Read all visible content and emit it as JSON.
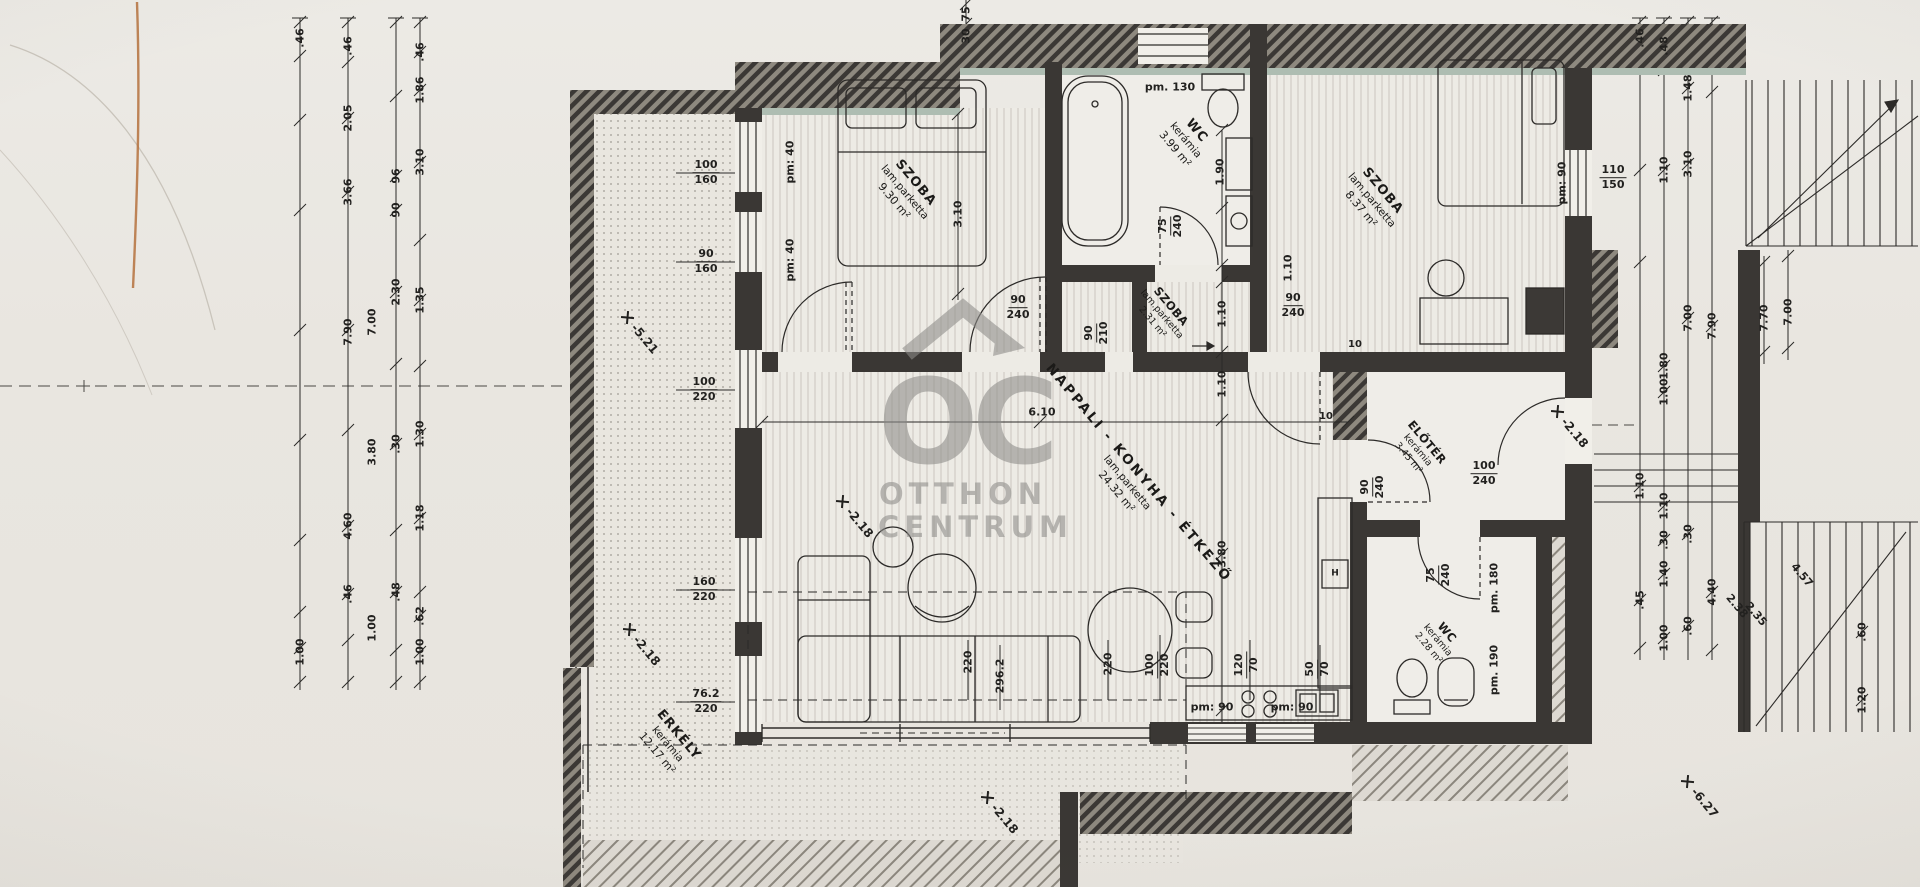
{
  "watermark": {
    "oc": "OC",
    "line1": "OTTHON",
    "line2": "CENTRUM"
  },
  "rooms": [
    {
      "name": "SZOBA",
      "mat": "lam.parketta",
      "area": "9.30 m²",
      "x": 905,
      "y": 192,
      "cls": ""
    },
    {
      "name": "WC",
      "mat": "kerámia",
      "area": "3.99 m²",
      "x": 1186,
      "y": 140,
      "cls": ""
    },
    {
      "name": "SZOBA",
      "mat": "lam.parketta",
      "area": "8.37 m²",
      "x": 1372,
      "y": 200,
      "cls": ""
    },
    {
      "name": "SZOBA",
      "mat": "lam.parketta",
      "area": "2.31 m²",
      "x": 1162,
      "y": 314,
      "cls": "sm"
    },
    {
      "name": "NAPPALI - KONYHA - ÉTKEZŐ",
      "mat": "lam.parketta",
      "area": "24.32 m²",
      "x": 1128,
      "y": 482,
      "cls": "big"
    },
    {
      "name": "ELŐTÉR",
      "mat": "kerámia",
      "area": "3.45 m²",
      "x": 1418,
      "y": 450,
      "cls": "sm"
    },
    {
      "name": "WC",
      "mat": "kerámia",
      "area": "2.28 m²",
      "x": 1438,
      "y": 640,
      "cls": "sm"
    },
    {
      "name": "ERKÉLY",
      "mat": "kerámia",
      "area": "12.17 m²",
      "x": 668,
      "y": 744,
      "cls": ""
    }
  ],
  "levels": [
    {
      "t": "-5.21",
      "x": 628,
      "y": 308
    },
    {
      "t": "-2.18",
      "x": 843,
      "y": 492
    },
    {
      "t": "-2.18",
      "x": 630,
      "y": 620
    },
    {
      "t": "-2.18",
      "x": 988,
      "y": 788
    },
    {
      "t": "-2.18",
      "x": 1558,
      "y": 402
    },
    {
      "t": "-6.27",
      "x": 1688,
      "y": 772
    }
  ],
  "fracs": [
    {
      "a": "100",
      "b": "160",
      "x": 706,
      "y": 173,
      "r": 0
    },
    {
      "a": "90",
      "b": "160",
      "x": 706,
      "y": 262,
      "r": 0
    },
    {
      "a": "100",
      "b": "220",
      "x": 704,
      "y": 390,
      "r": 0
    },
    {
      "a": "160",
      "b": "220",
      "x": 704,
      "y": 590,
      "r": 0
    },
    {
      "a": "76.2",
      "b": "220",
      "x": 706,
      "y": 702,
      "r": 0
    },
    {
      "a": "90",
      "b": "240",
      "x": 1018,
      "y": 308,
      "r": 0
    },
    {
      "a": "90",
      "b": "210",
      "x": 1097,
      "y": 333,
      "r": -90
    },
    {
      "a": "75",
      "b": "240",
      "x": 1171,
      "y": 226,
      "r": -90
    },
    {
      "a": "90",
      "b": "240",
      "x": 1293,
      "y": 306,
      "r": 0
    },
    {
      "a": "110",
      "b": "150",
      "x": 1613,
      "y": 178,
      "r": 0
    },
    {
      "a": "100",
      "b": "240",
      "x": 1484,
      "y": 474,
      "r": 0
    },
    {
      "a": "90",
      "b": "240",
      "x": 1373,
      "y": 487,
      "r": -90
    },
    {
      "a": "75",
      "b": "240",
      "x": 1439,
      "y": 575,
      "r": -90
    },
    {
      "a": "100",
      "b": "220",
      "x": 1158,
      "y": 665,
      "r": -90
    },
    {
      "a": "120",
      "b": "70",
      "x": 1247,
      "y": 665,
      "r": -90
    },
    {
      "a": "50",
      "b": "70",
      "x": 1318,
      "y": 669,
      "r": -90
    }
  ],
  "texts": [
    {
      "t": ".46",
      "x": 300,
      "y": 38,
      "r": -90
    },
    {
      "t": ".46",
      "x": 348,
      "y": 46,
      "r": -90
    },
    {
      "t": ".46",
      "x": 420,
      "y": 52,
      "r": -90
    },
    {
      "t": "1.86",
      "x": 420,
      "y": 90,
      "r": -90
    },
    {
      "t": "2.05",
      "x": 348,
      "y": 118,
      "r": -90
    },
    {
      "t": "3.10",
      "x": 420,
      "y": 162,
      "r": -90
    },
    {
      "t": "96",
      "x": 396,
      "y": 176,
      "r": -90
    },
    {
      "t": "3.66",
      "x": 348,
      "y": 192,
      "r": -90
    },
    {
      "t": "90",
      "x": 396,
      "y": 210,
      "r": -90
    },
    {
      "t": "2.30",
      "x": 396,
      "y": 292,
      "r": -90
    },
    {
      "t": "1.35",
      "x": 420,
      "y": 300,
      "r": -90
    },
    {
      "t": "7.00",
      "x": 372,
      "y": 322,
      "r": -90
    },
    {
      "t": "7.90",
      "x": 348,
      "y": 332,
      "r": -90
    },
    {
      "t": "1.30",
      "x": 420,
      "y": 434,
      "r": -90
    },
    {
      "t": ".30",
      "x": 396,
      "y": 444,
      "r": -90
    },
    {
      "t": "3.80",
      "x": 372,
      "y": 452,
      "r": -90
    },
    {
      "t": "1.18",
      "x": 420,
      "y": 518,
      "r": -90
    },
    {
      "t": "4.60",
      "x": 348,
      "y": 526,
      "r": -90
    },
    {
      "t": ".46",
      "x": 348,
      "y": 594,
      "r": -90
    },
    {
      "t": ".48",
      "x": 396,
      "y": 592,
      "r": -90
    },
    {
      "t": ".62",
      "x": 420,
      "y": 616,
      "r": -90
    },
    {
      "t": "1.00",
      "x": 372,
      "y": 628,
      "r": -90
    },
    {
      "t": "1.00",
      "x": 420,
      "y": 652,
      "r": -90
    },
    {
      "t": "1.00",
      "x": 300,
      "y": 652,
      "r": -90
    },
    {
      "t": ".46",
      "x": 1640,
      "y": 38,
      "r": -90
    },
    {
      "t": ".48",
      "x": 1664,
      "y": 46,
      "r": -90
    },
    {
      "t": "1.48",
      "x": 1688,
      "y": 88,
      "r": -90
    },
    {
      "t": "1.10",
      "x": 1664,
      "y": 170,
      "r": -90
    },
    {
      "t": "3.10",
      "x": 1688,
      "y": 164,
      "r": -90
    },
    {
      "t": "7.00",
      "x": 1688,
      "y": 318,
      "r": -90
    },
    {
      "t": "7.90",
      "x": 1712,
      "y": 326,
      "r": -90
    },
    {
      "t": "1.80",
      "x": 1664,
      "y": 366,
      "r": -90
    },
    {
      "t": "1.00",
      "x": 1664,
      "y": 392,
      "r": -90
    },
    {
      "t": "7.70",
      "x": 1764,
      "y": 318,
      "r": -90
    },
    {
      "t": "7.00",
      "x": 1788,
      "y": 312,
      "r": -90
    },
    {
      "t": "1.10",
      "x": 1640,
      "y": 486,
      "r": -90
    },
    {
      "t": "1.10",
      "x": 1664,
      "y": 506,
      "r": -90
    },
    {
      "t": ".30",
      "x": 1688,
      "y": 534,
      "r": -90
    },
    {
      "t": ".30",
      "x": 1664,
      "y": 540,
      "r": -90
    },
    {
      "t": "1.40",
      "x": 1664,
      "y": 574,
      "r": -90
    },
    {
      "t": ".45",
      "x": 1640,
      "y": 600,
      "r": -90
    },
    {
      "t": "4.40",
      "x": 1712,
      "y": 592,
      "r": -90
    },
    {
      "t": ".60",
      "x": 1688,
      "y": 626,
      "r": -90
    },
    {
      "t": "1.00",
      "x": 1664,
      "y": 638,
      "r": -90
    },
    {
      "t": ".60",
      "x": 1862,
      "y": 632,
      "r": -90
    },
    {
      "t": "1.20",
      "x": 1862,
      "y": 700,
      "r": -90
    },
    {
      "t": "75",
      "x": 966,
      "y": 14,
      "r": -90
    },
    {
      "t": "30",
      "x": 966,
      "y": 36,
      "r": -90
    },
    {
      "t": "220",
      "x": 968,
      "y": 662,
      "r": -90
    },
    {
      "t": "296.2",
      "x": 1000,
      "y": 676,
      "r": -90
    },
    {
      "t": "220",
      "x": 1108,
      "y": 664,
      "r": -90
    },
    {
      "t": "pm: 40",
      "x": 790,
      "y": 162,
      "r": -90
    },
    {
      "t": "pm: 40",
      "x": 790,
      "y": 260,
      "r": -90
    },
    {
      "t": "pm. 130",
      "x": 1170,
      "y": 87,
      "r": 0
    },
    {
      "t": "pm: 90",
      "x": 1562,
      "y": 183,
      "r": -90
    },
    {
      "t": "pm. 180",
      "x": 1494,
      "y": 588,
      "r": -90
    },
    {
      "t": "pm. 190",
      "x": 1494,
      "y": 670,
      "r": -90
    },
    {
      "t": "pm: 90",
      "x": 1212,
      "y": 707,
      "r": 0
    },
    {
      "t": "pm: 90",
      "x": 1292,
      "y": 707,
      "r": 0
    },
    {
      "t": "3.10",
      "x": 958,
      "y": 214,
      "r": -90
    },
    {
      "t": "1.90",
      "x": 1220,
      "y": 172,
      "r": -90
    },
    {
      "t": "6.10",
      "x": 1042,
      "y": 412,
      "r": 0
    },
    {
      "t": "3.80",
      "x": 1222,
      "y": 554,
      "r": -90
    },
    {
      "t": "1.10",
      "x": 1222,
      "y": 314,
      "r": -90
    },
    {
      "t": "1.10",
      "x": 1222,
      "y": 384,
      "r": -90
    },
    {
      "t": "1.10",
      "x": 1288,
      "y": 268,
      "r": -90
    },
    {
      "t": "10",
      "x": 1326,
      "y": 417,
      "r": 0,
      "fs": 10
    },
    {
      "t": "10",
      "x": 1355,
      "y": 345,
      "r": 0,
      "fs": 10
    },
    {
      "t": "2.38",
      "x": 1737,
      "y": 606,
      "r": 50
    },
    {
      "t": "2.35",
      "x": 1756,
      "y": 614,
      "r": 50
    },
    {
      "t": "4.57",
      "x": 1802,
      "y": 575,
      "r": 50
    },
    {
      "t": "H",
      "x": 1335,
      "y": 574,
      "r": 0,
      "fs": 9
    }
  ]
}
